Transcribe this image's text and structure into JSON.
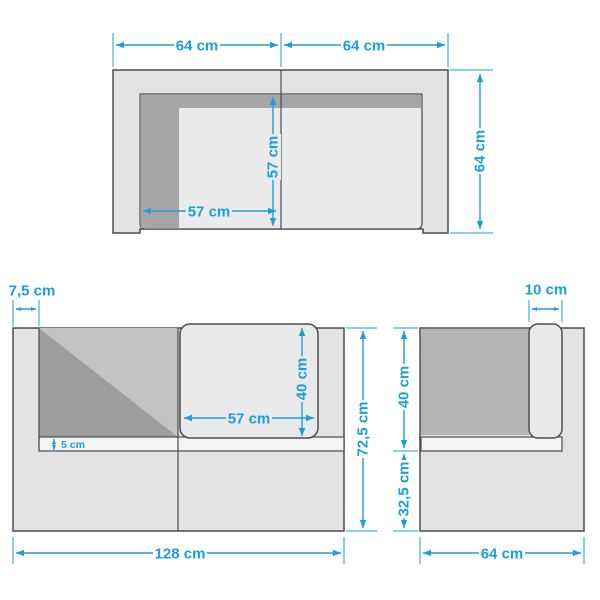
{
  "diagram": "sofa-dimension-drawing",
  "unit": "cm",
  "colors": {
    "background": "#ffffff",
    "dimension_blue": "#1a9fd9",
    "outline_dark": "#4d4d4d",
    "body_gray": "#e3e3e3",
    "seat_gray": "#ebebeb",
    "cushion_gray": "#e9e9e9",
    "shadow_medium": "#a6a6a6",
    "side_back_gray": "#b5b5b5",
    "back_upper_gray": "#c3c3c3",
    "shadow_dark": "#9d9d9d",
    "platform_white": "#f4f4f4"
  },
  "views": {
    "top": {
      "dims": {
        "width_left": "64 cm",
        "width_right": "64 cm",
        "depth": "64 cm",
        "seat_depth": "57 cm",
        "seat_width": "57 cm"
      }
    },
    "front": {
      "dims": {
        "armrest_width": "7,5 cm",
        "cushion_width": "57 cm",
        "cushion_height": "40 cm",
        "platform_thickness": "5 cm",
        "total_height": "72,5 cm",
        "total_width": "128 cm"
      }
    },
    "side": {
      "dims": {
        "backrest_thickness": "10 cm",
        "backrest_height": "40 cm",
        "base_height": "32,5 cm",
        "depth": "64 cm"
      }
    }
  }
}
